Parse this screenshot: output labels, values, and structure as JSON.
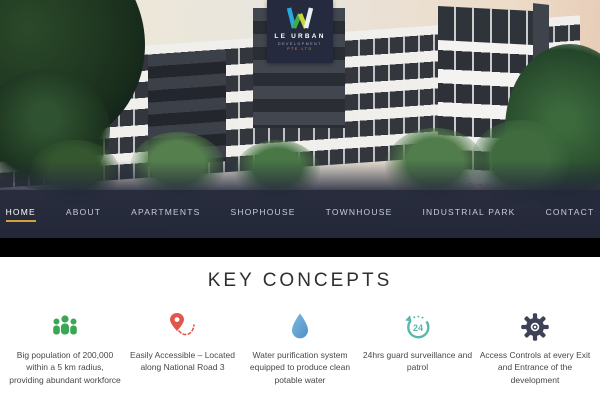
{
  "logo": {
    "name": "LE URBAN",
    "subtitle": "DEVELOPMENT",
    "subtitle2": "PTE LTD"
  },
  "nav": {
    "items": [
      {
        "label": "HOME",
        "active": true
      },
      {
        "label": "ABOUT",
        "active": false
      },
      {
        "label": "APARTMENTS",
        "active": false
      },
      {
        "label": "SHOPHOUSE",
        "active": false
      },
      {
        "label": "TOWNHOUSE",
        "active": false
      },
      {
        "label": "INDUSTRIAL PARK",
        "active": false
      },
      {
        "label": "CONTACT",
        "active": false
      }
    ]
  },
  "concepts": {
    "title": "KEY CONCEPTS",
    "features": [
      {
        "icon": "people-group-icon",
        "color": "#3BA653",
        "text": "Big population of 200,000 within a 5 km radius, providing abundant workforce"
      },
      {
        "icon": "location-pin-icon",
        "color": "#E2574C",
        "text": "Easily Accessible – Located along National Road 3"
      },
      {
        "icon": "water-drop-icon",
        "color": "#63A8D8",
        "text": "Water purification system equipped to produce clean potable water"
      },
      {
        "icon": "24-hour-icon",
        "color": "#57B8AC",
        "badge": "24",
        "text": "24hrs guard surveillance and patrol"
      },
      {
        "icon": "gear-icon",
        "color": "#3D4256",
        "text": "Access Controls at every Exit and Entrance of the development"
      }
    ]
  },
  "colors": {
    "nav_active_underline": "#d4a23c",
    "nav_background": "rgba(36,40,57,0.84)",
    "band": "#000000",
    "heading_text": "#2f2f2f"
  }
}
